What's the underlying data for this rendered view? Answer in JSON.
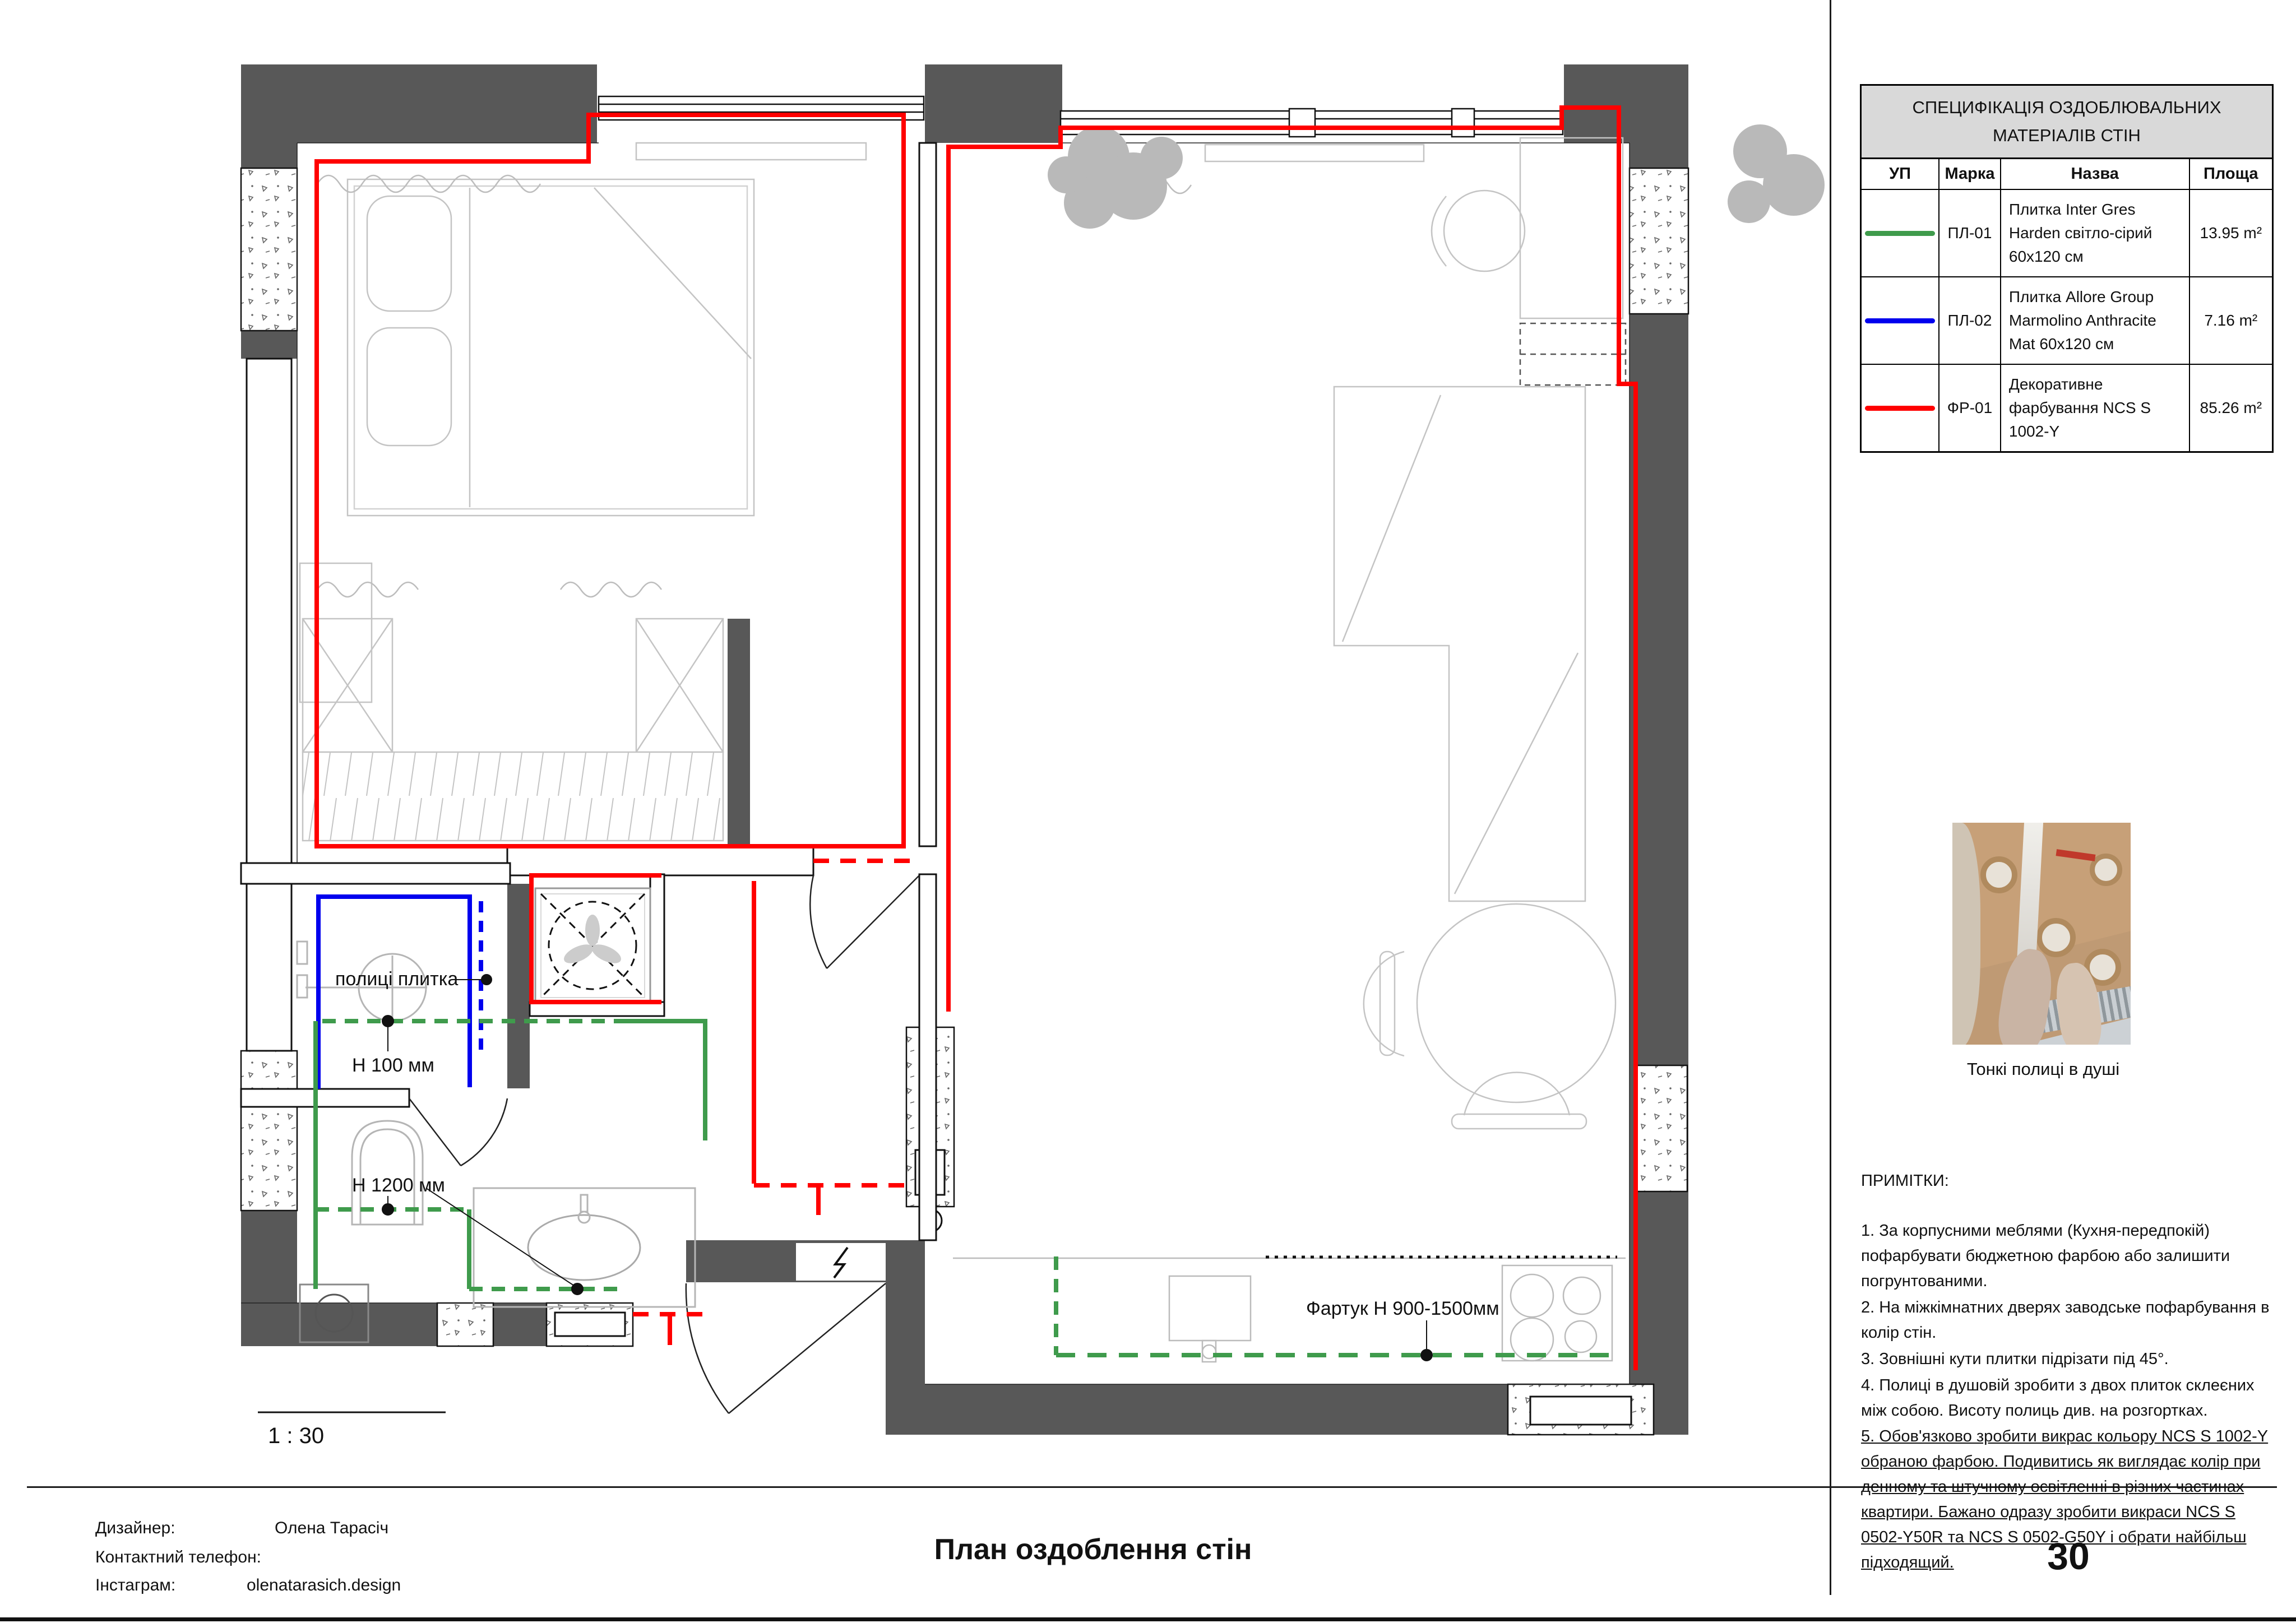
{
  "spec_table": {
    "title": "СПЕЦИФІКАЦІЯ ОЗДОБЛЮВАЛЬНИХ МАТЕРІАЛІВ СТІН",
    "columns": [
      "УП",
      "Марка",
      "Назва",
      "Площа"
    ],
    "rows": [
      {
        "color": "#3f9b4c",
        "mark": "ПЛ-01",
        "name": "Плитка Inter Gres Harden світло-сірий 60х120 см",
        "area": "13.95 m²"
      },
      {
        "color": "#0000ee",
        "mark": "ПЛ-02",
        "name": "Плитка Allore Group Marmolino Anthracite Mat 60x120 см",
        "area": "7.16 m²"
      },
      {
        "color": "#ff0000",
        "mark": "ФР-01",
        "name": "Декоративне фарбування NCS S 1002-Y",
        "area": "85.26 m²"
      }
    ]
  },
  "photo": {
    "caption": "Тонкі полиці в душі"
  },
  "notes": {
    "heading": "ПРИМІТКИ:",
    "items": [
      "1. За корпусними меблями (Кухня-передпокій) пофарбувати бюджетною фарбою або залишити погрунтованими.",
      "2. На міжкімнатних дверях заводське пофарбування в колір стін.",
      "3. Зовнішні кути плитки підрізати під 45°.",
      "4. Полиці в душовій зробити з двох плиток склеєних між собою. Висоту полиць див. на розгортках.",
      "5. Обов'язково зробити викрас кольору NCS S 1002-Y обраною фарбою. Подивитись як виглядає колір при денному та штучному освітленні в різних частинах квартири. Бажано одразу зробити викраси NCS S 0502-Y50R та NCS S 0502-G50Y і обрати найбільш підходящий."
    ]
  },
  "plan": {
    "scale": "1 : 30",
    "labels": {
      "shelves": "полиці плитка",
      "h100": "Н 100 мм",
      "h1200": "Н 1200 мм",
      "apron": "Фартук Н 900-1500мм"
    },
    "finish_colors": {
      "tile_pl01": "#3f9b4c",
      "tile_pl02": "#0000ee",
      "paint_fr01": "#ff0000"
    }
  },
  "title_block": {
    "designer_label": "Дизайнер:",
    "designer": "Олена Тарасіч",
    "phone_label": "Контактний телефон:",
    "instagram_label": "Інстаграм:",
    "instagram": "olenatarasich.design",
    "sheet_title": "План оздоблення стін",
    "page_number": "30"
  }
}
